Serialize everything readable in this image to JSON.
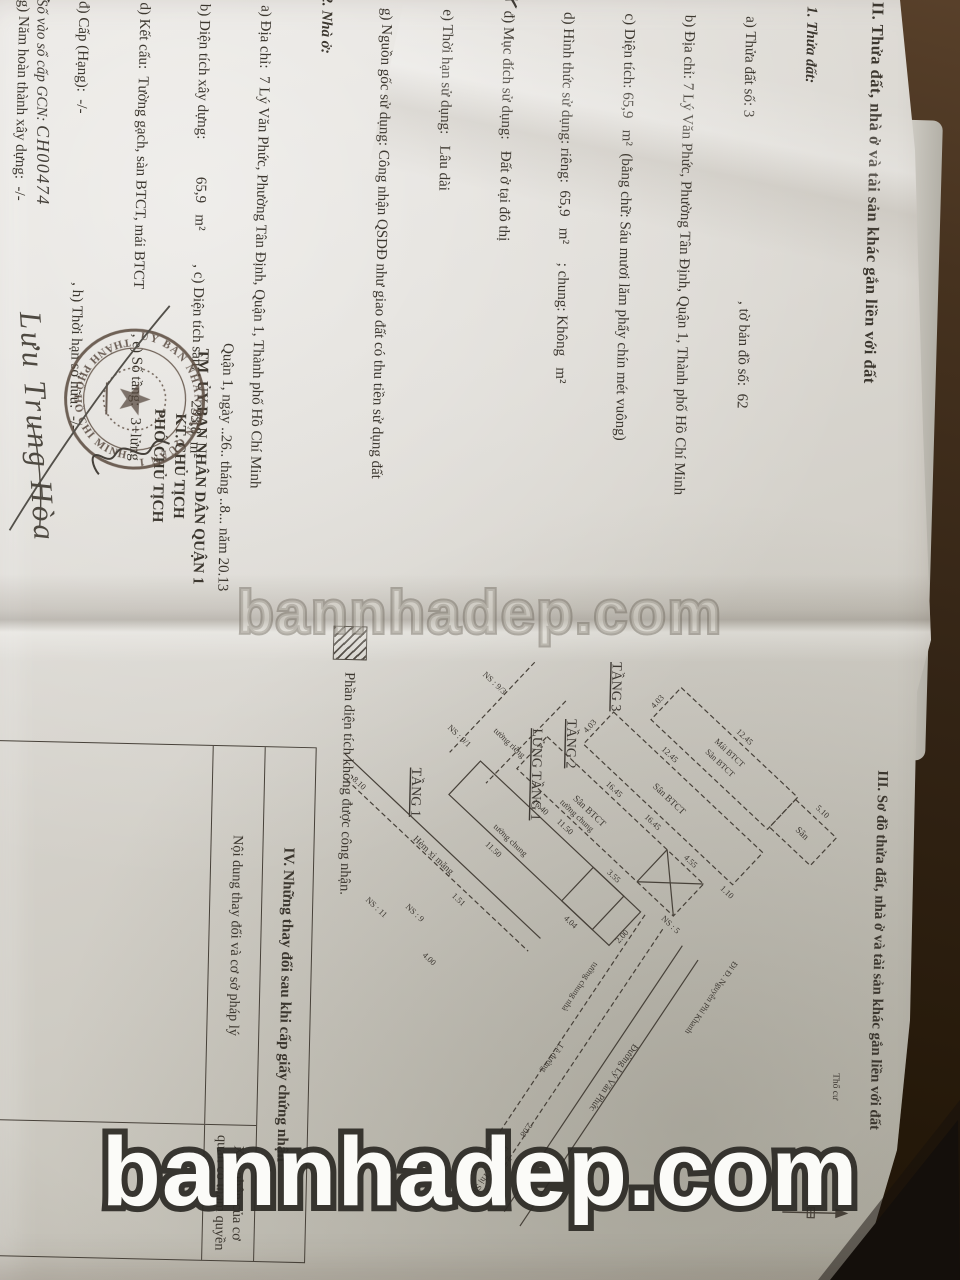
{
  "watermark": {
    "text": "bannhadep.com"
  },
  "pen_mark": "✗",
  "left_page": {
    "heading": "II. Thửa đất, nhà ở và tài sản khác gắn liền với đất",
    "sec1_title": "1. Thửa đất:",
    "sec1": [
      "   a) Thửa đất số: 3                                                 , tờ bản đồ số:  62",
      "   b) Địa chỉ: 7 Lý Văn Phức, Phường Tân Định, Quận 1, Thành phố Hồ Chí Minh",
      "   c) Diện tích: 65,9   m²  (bằng chữ: Sáu mươi lăm phẩy chín mét vuông)",
      "   d) Hình thức sử dụng: riêng:  65,9   m²     ; chung: Không   m²",
      "   đ) Mục đích sử dụng:   Đất ở tại đô thị",
      "   e) Thời hạn sử dụng:   Lâu dài",
      "   g) Nguồn gốc sử dụng: Công nhận QSDĐ như giao đất có thu tiền sử dụng đất"
    ],
    "sec2_title": "2. Nhà ở:",
    "sec2": [
      "   a) Địa chỉ:  7 Lý Văn Phức, Phường Tân Định, Quận 1, Thành phố Hồ Chí Minh",
      "   b) Diện tích xây dựng:          65,9   m²         , c) Diện tích sàn:        233,8  m²",
      "   d) Kết cấu:  Tường gạch, sàn BTCT, mái BTCT            , e) Số tầng:   3+lửng",
      "   đ) Cấp (Hạng):  -/-                                             , h) Thời hạn sở hữu:  -/-",
      "   g) Năm hoàn thành xây dựng:  -/-"
    ],
    "sec3": "3. Công trình xây dựng khác: -/-.",
    "sec4": "4. Rừng sản xuất là rừng trồng:-/-.",
    "sec5": "5. Cây lâu năm: -/-.",
    "sec6_title": "6. Ghi chú:",
    "note1": "   Thu hồi giấy chứng nhận quyền sử dụng đất, quyền sở hữu nhà ở và tài sản khác gắn",
    "note2": "với đất số CH0373 và CH0374 ngày 17/02/2011 của UBND quận 1.",
    "sign_place_date": "Quận 1, ngày ..26.. tháng ..8... năm 20.13",
    "sign_org": "TM. ỦY BAN NHÂN DÂN QUẬN 1",
    "sign_kt": "KT. CHỦ TỊCH",
    "sign_title": "PHÓ CHỦ TỊCH",
    "signer_name": "Lưu Trung Hòa",
    "book_entry_label": "Số vào sổ cấp GCN: ",
    "book_entry_value": "CH00474",
    "stamp_top": "ỦY BAN NHÂN DÂN QUẬN 1",
    "stamp_bottom": "THÀNH PHỐ HỒ CHÍ MINH"
  },
  "right_page": {
    "heading": "III. Sơ đồ thửa đất, nhà ở và tài sản khác gắn liền với đất",
    "floors": {
      "t1": "TẦNG 1",
      "lung": "LỬNG TẦNG 1",
      "t2": "TẦNG 2",
      "t3": "TẦNG 3"
    },
    "areas": {
      "mai": "Mái BTCT",
      "san_btct": "Sân BTCT",
      "san": "Sân"
    },
    "dims": {
      "d1245": "12.45",
      "d510": "5.10",
      "d403": "4.03",
      "d1645": "16.45",
      "d1150": "11.50",
      "d455": "4.55",
      "d1640": "16.40",
      "d355": "3.55",
      "d200": "2.00",
      "d404": "4.04",
      "d208": "2.08",
      "d250": "2.50",
      "d810": "8.10",
      "d400": "4.00",
      "d110": "1.10",
      "d151": "1.51"
    },
    "neighbors": {
      "n93": "NS : 9/3",
      "n91": "NS : 9/1",
      "n9": "NS : 9",
      "n5": "NS : 5",
      "n11": "NS : 11"
    },
    "streets": {
      "hem": "Hẻm xi măng",
      "lvp": "Đường Lý Văn Phức",
      "le": "Lề đường",
      "dir_npk": "Đi Đ. Nguyễn Phi Khanh",
      "dir_vts": "Đi Đ. Võ Thị Sáu"
    },
    "walls": {
      "chung": "tường chung",
      "rieng": "tường riêng",
      "chung_nha": "tường chung nhà"
    },
    "tho_cu": "Thổ cư",
    "legend": "Phần diện tích không được công nhận.",
    "table": {
      "title": "IV. Những thay đổi sau khi cấp giấy chứng nhận",
      "col1": "Nội dung thay đổi và cơ sở pháp lý",
      "col2": "Xác nhận của cơ quan có thẩm quyền"
    }
  }
}
